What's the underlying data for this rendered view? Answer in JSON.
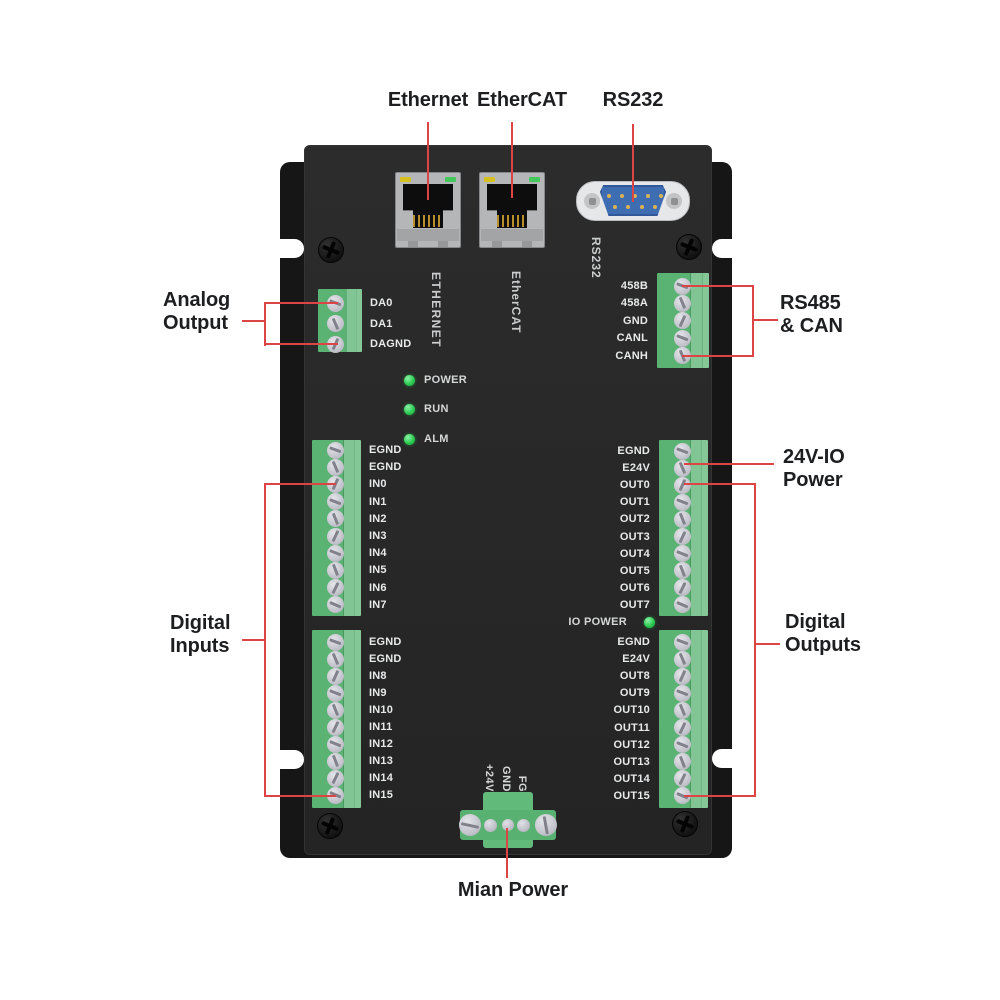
{
  "annotations": {
    "ethernet": "Ethernet",
    "ethercat": "EtherCAT",
    "rs232": "RS232",
    "analog_output": "Analog\nOutput",
    "rs485_can": "RS485\n& CAN",
    "power_24v_io": "24V-IO\nPower",
    "digital_inputs": "Digital\nInputs",
    "digital_outputs": "Digital\nOutputs",
    "main_power": "Mian Power"
  },
  "panel": {
    "silkscreen": {
      "ethernet": "ETHERNET",
      "ethercat": "EtherCAT",
      "rs232": "RS232"
    },
    "status_leds": [
      "POWER",
      "RUN",
      "ALM"
    ],
    "io_power_label": "IO POWER",
    "terminal_blocks": {
      "analog_output": [
        "DA0",
        "DA1",
        "DAGND"
      ],
      "rs485_can": [
        "458B",
        "458A",
        "GND",
        "CANL",
        "CANH"
      ],
      "digital_inputs_upper": [
        "EGND",
        "EGND",
        "IN0",
        "IN1",
        "IN2",
        "IN3",
        "IN4",
        "IN5",
        "IN6",
        "IN7"
      ],
      "digital_inputs_lower": [
        "EGND",
        "EGND",
        "IN8",
        "IN9",
        "IN10",
        "IN11",
        "IN12",
        "IN13",
        "IN14",
        "IN15"
      ],
      "digital_outputs_upper": [
        "EGND",
        "E24V",
        "OUT0",
        "OUT1",
        "OUT2",
        "OUT3",
        "OUT4",
        "OUT5",
        "OUT6",
        "OUT7"
      ],
      "digital_outputs_lower": [
        "EGND",
        "E24V",
        "OUT8",
        "OUT9",
        "OUT10",
        "OUT11",
        "OUT12",
        "OUT13",
        "OUT14",
        "OUT15"
      ]
    },
    "main_power_pins": [
      "+24V",
      "GND",
      "FG"
    ]
  },
  "colors": {
    "annotation_line": "#dc4543",
    "terminal_green": "#57b070",
    "led_green": "#2ecc52",
    "rs232_blue": "#3e6db2"
  }
}
